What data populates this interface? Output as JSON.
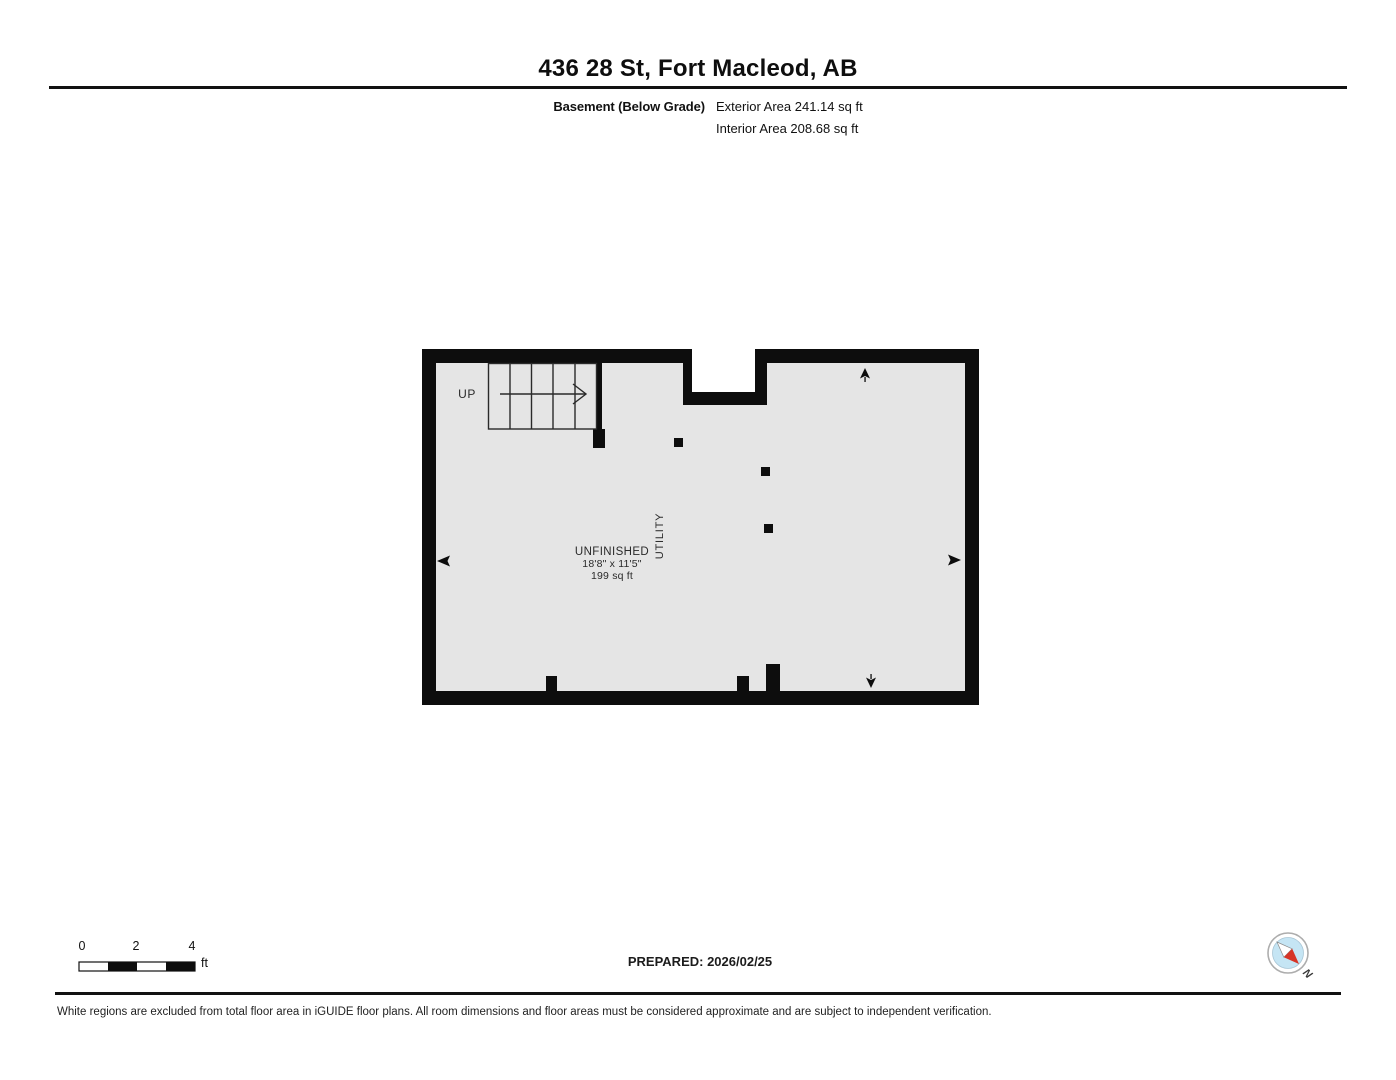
{
  "header": {
    "title": "436 28 St, Fort Macleod, AB",
    "floor_label": "Basement (Below Grade)",
    "exterior_area": "Exterior Area 241.14 sq ft",
    "interior_area": "Interior Area 208.68 sq ft"
  },
  "plan": {
    "up_label": "UP",
    "room_name": "UNFINISHED",
    "room_dimensions": "18'8\" x 11'5\"",
    "room_area": "199 sq ft",
    "utility_label": "UTILITY"
  },
  "footer": {
    "scale_ticks": [
      "0",
      "2",
      "4"
    ],
    "scale_unit": "ft",
    "prepared": "PREPARED: 2026/02/25",
    "compass_north": "N",
    "disclaimer": "White regions are excluded from total floor area in iGUIDE floor plans. All room dimensions and floor areas must be considered approximate and are subject to independent verification."
  },
  "colors": {
    "wall": "#0d0d0d",
    "floor": "#e5e5e5",
    "compass_fill": "#c5e5f4",
    "needle_red": "#d63426",
    "needle_white": "#ffffff"
  }
}
